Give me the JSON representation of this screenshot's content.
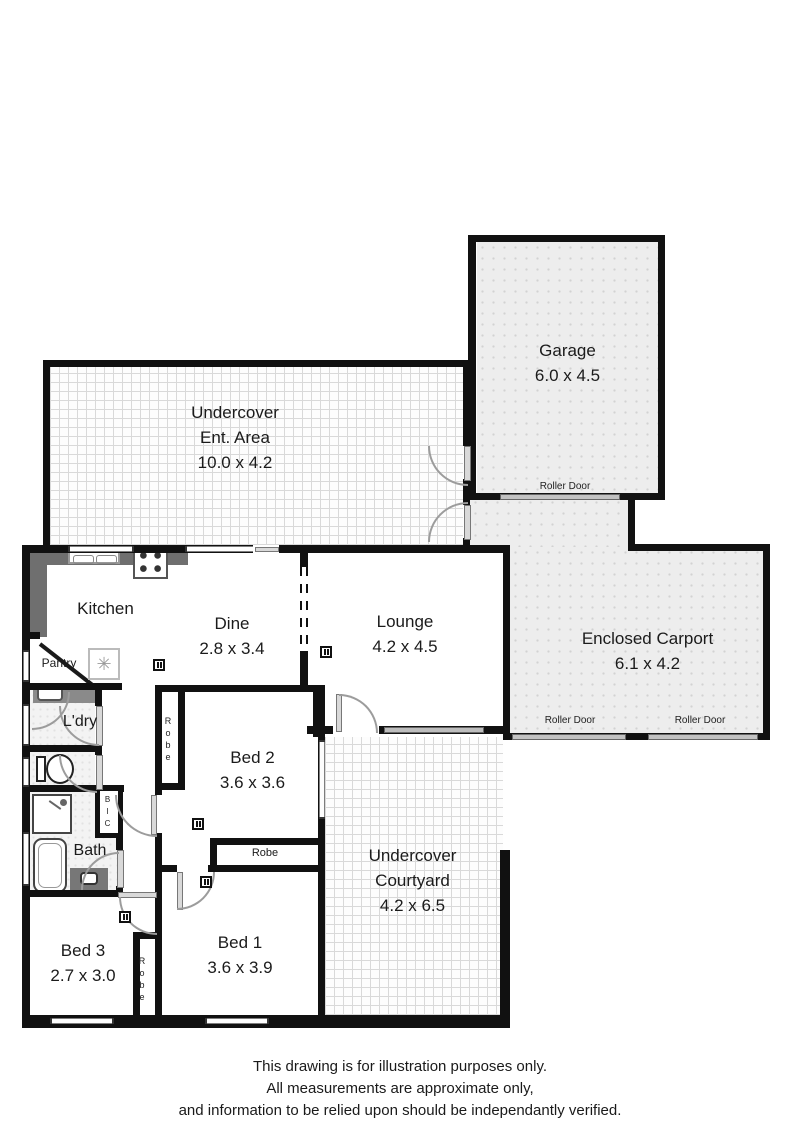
{
  "plan": {
    "garage": {
      "name": "Garage",
      "dims": "6.0 x 4.5"
    },
    "ent": {
      "line1": "Undercover",
      "line2": "Ent. Area",
      "dims": "10.0 x 4.2"
    },
    "kitchen": {
      "name": "Kitchen"
    },
    "dine": {
      "name": "Dine",
      "dims": "2.8 x 3.4"
    },
    "lounge": {
      "name": "Lounge",
      "dims": "4.2 x 4.5"
    },
    "carport": {
      "name": "Enclosed Carport",
      "dims": "6.1 x 4.2"
    },
    "courtyard": {
      "line1": "Undercover",
      "line2": "Courtyard",
      "dims": "4.2 x 6.5"
    },
    "bed1": {
      "name": "Bed 1",
      "dims": "3.6 x 3.9"
    },
    "bed2": {
      "name": "Bed 2",
      "dims": "3.6 x 3.6"
    },
    "bed3": {
      "name": "Bed 3",
      "dims": "2.7 x 3.0"
    },
    "pantry": {
      "name": "Pantry"
    },
    "laundry": {
      "name": "L'dry"
    },
    "bath": {
      "name": "Bath"
    },
    "robe": "Robe",
    "bic": "BIC",
    "roller_door": "Roller Door",
    "hot_water_symbol": "✳"
  },
  "disclaimer": {
    "line1": "This drawing is for illustration purposes only.",
    "line2": "All measurements are approximate only,",
    "line3": "and information to be relied upon should be independantly verified."
  },
  "colors": {
    "wall": "#111111",
    "paving_line": "#d9d9d9",
    "concrete_fill": "#ededed",
    "window_gray": "#7d7d7d",
    "counter_gray": "#6f6f6f"
  }
}
